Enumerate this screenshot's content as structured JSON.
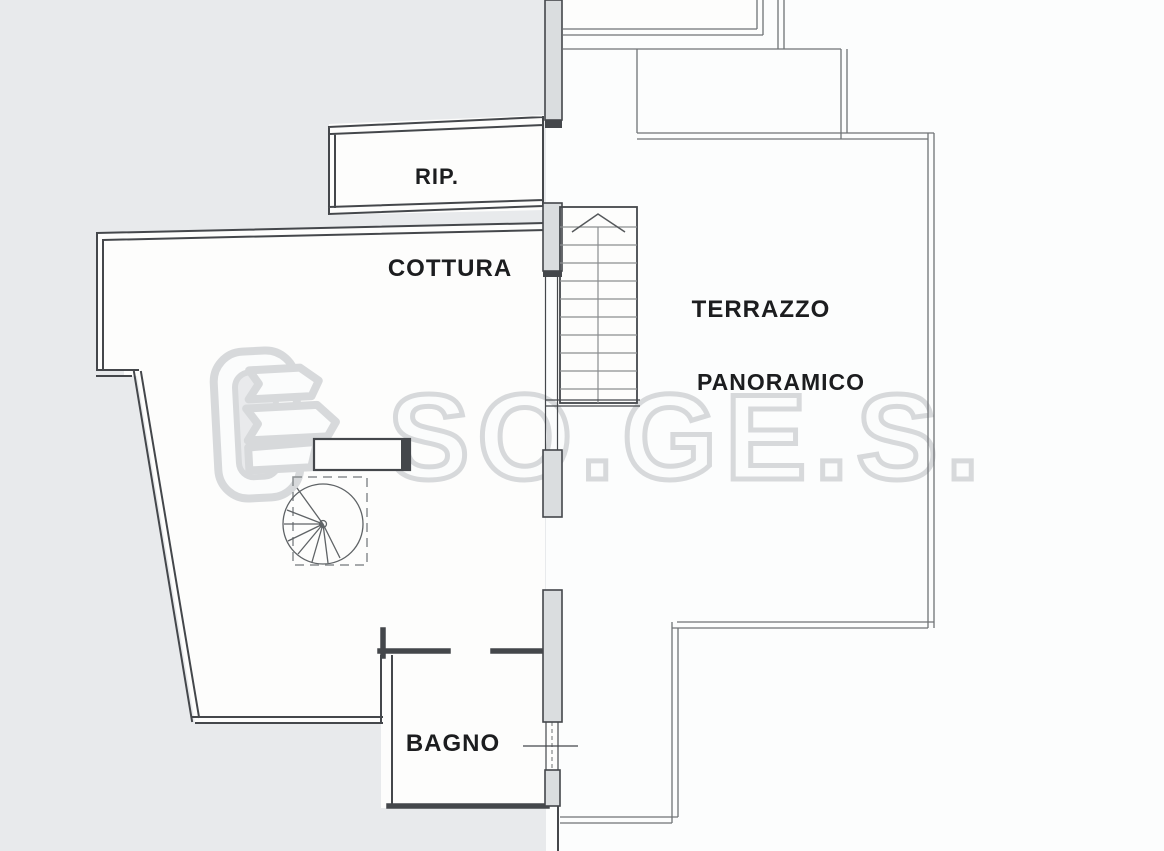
{
  "rooms": {
    "rip": {
      "label": "RIP."
    },
    "cottura": {
      "label": "COTTURA"
    },
    "terrazzo": {
      "label_line_1": "TERRAZZO",
      "label_line_2": "PANORAMICO"
    },
    "bagno": {
      "label": "BAGNO"
    }
  },
  "watermark": {
    "text": "SO.GE.S."
  },
  "icons": {
    "stair_direction": "chevron-up-icon"
  },
  "colors": {
    "bg-gray": "#e8eaec",
    "paper-white": "#fcfdfd",
    "room-fill": "#fdfdfc",
    "line-dark": "#44474b",
    "wall-fill": "#dadddf",
    "terrace-line": "#6f7376",
    "tread-line": "#8b8e90",
    "label-ink": "#1c1d1f",
    "watermark-gray": "#d6d8da",
    "watermark-fill": "#fbfcfc"
  }
}
